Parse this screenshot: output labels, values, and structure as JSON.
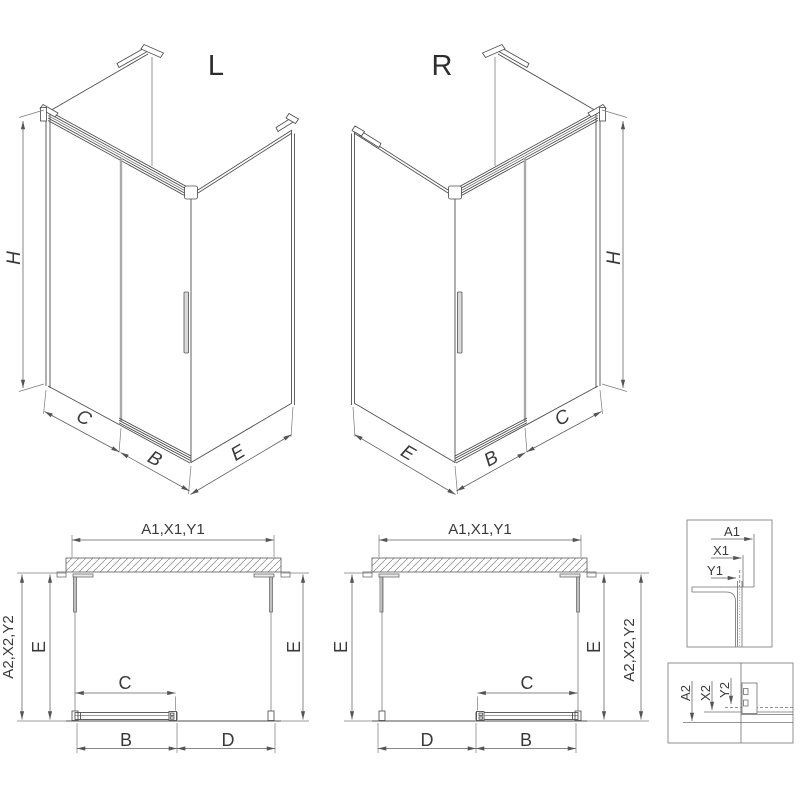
{
  "document": {
    "kind": "technical-drawing",
    "subject": "corner shower enclosure with sliding door, left and right versions",
    "views": [
      "isometric L",
      "isometric R",
      "plan L",
      "plan R",
      "wall profile detail",
      "bottom rail detail"
    ]
  },
  "iso_left": {
    "title": "L",
    "dims": {
      "height": "H",
      "front_fixed": "C",
      "front_door": "B",
      "side": "E"
    }
  },
  "iso_right": {
    "title": "R",
    "dims": {
      "side": "E",
      "front_door": "B",
      "front_fixed": "C",
      "height": "H"
    }
  },
  "plan_left": {
    "dims": {
      "width_top": "A1,X1,Y1",
      "left_outer": "A2,X2,Y2",
      "depth_left": "E",
      "depth_right": "E",
      "door": "C",
      "bottom_left": "B",
      "bottom_right": "D"
    }
  },
  "plan_right": {
    "dims": {
      "width_top": "A1,X1,Y1",
      "depth_left": "E",
      "depth_right": "E",
      "right_outer": "A2,X2,Y2",
      "door": "C",
      "bottom_left": "D",
      "bottom_right": "B"
    }
  },
  "detail_top_profile": {
    "dims": {
      "first": "A1",
      "second": "X1",
      "third": "Y1"
    }
  },
  "detail_bottom_profile": {
    "dims": {
      "first": "A2",
      "second": "X2",
      "third": "Y2"
    }
  },
  "colors": {
    "line": "#4f4f4f",
    "secondary_line": "#7d7d7d",
    "dim_line": "#5f5f5f",
    "glass_edge": "#a9a9a9",
    "text": "#3a3a3a",
    "background": "#ffffff"
  }
}
